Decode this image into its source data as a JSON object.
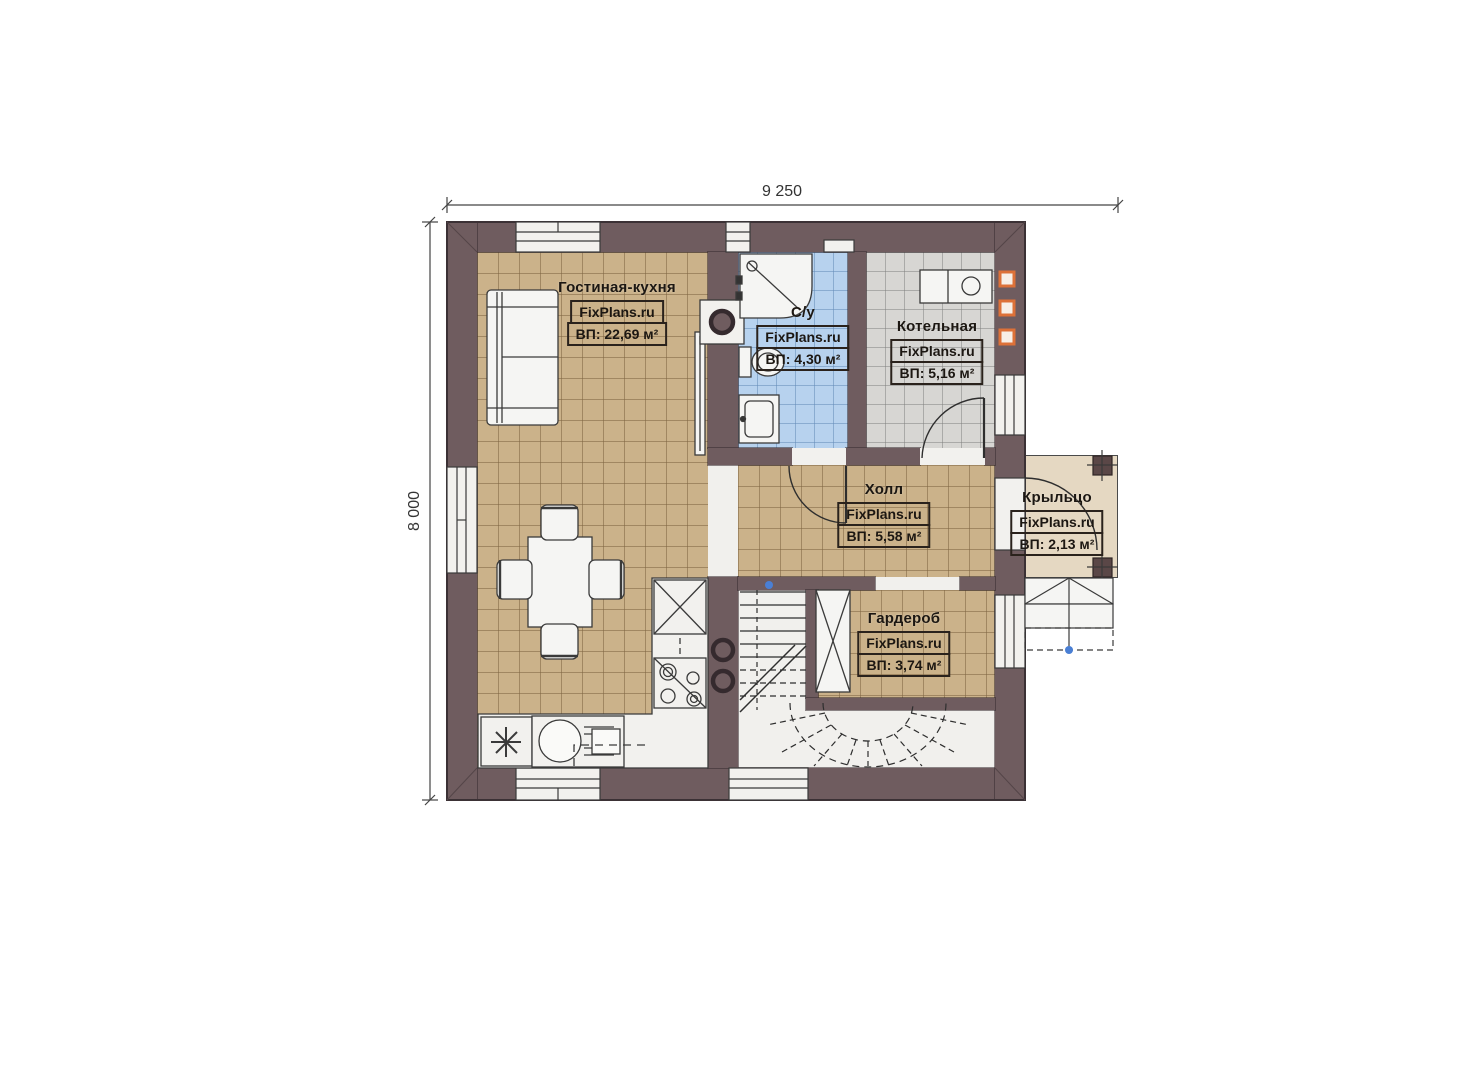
{
  "dimensions": {
    "top_label": "9 250",
    "left_label": "8 000"
  },
  "rooms": {
    "living": {
      "name": "Гостиная-кухня",
      "brand": "FixPlans.ru",
      "area": "ВП: 22,69 м²"
    },
    "bathroom": {
      "name": "С/у",
      "brand": "FixPlans.ru",
      "area": "ВП: 4,30 м²"
    },
    "boiler": {
      "name": "Котельная",
      "brand": "FixPlans.ru",
      "area": "ВП: 5,16 м²"
    },
    "hall": {
      "name": "Холл",
      "brand": "FixPlans.ru",
      "area": "ВП: 5,58 м²"
    },
    "wardrobe": {
      "name": "Гардероб",
      "brand": "FixPlans.ru",
      "area": "ВП: 3,74 м²"
    },
    "porch": {
      "name": "Крыльцо",
      "brand": "FixPlans.ru",
      "area": "ВП: 2,13 м²"
    }
  },
  "colors": {
    "wall": "#6f5c5f",
    "floor_wood": "#cbb28a",
    "floor_bathroom": "#b7d2ee",
    "floor_boiler": "#d7d6d3",
    "floor_porch": "#e5d8c2",
    "vent_accent": "#dd7138",
    "marker_blue": "#4a7fd4"
  }
}
